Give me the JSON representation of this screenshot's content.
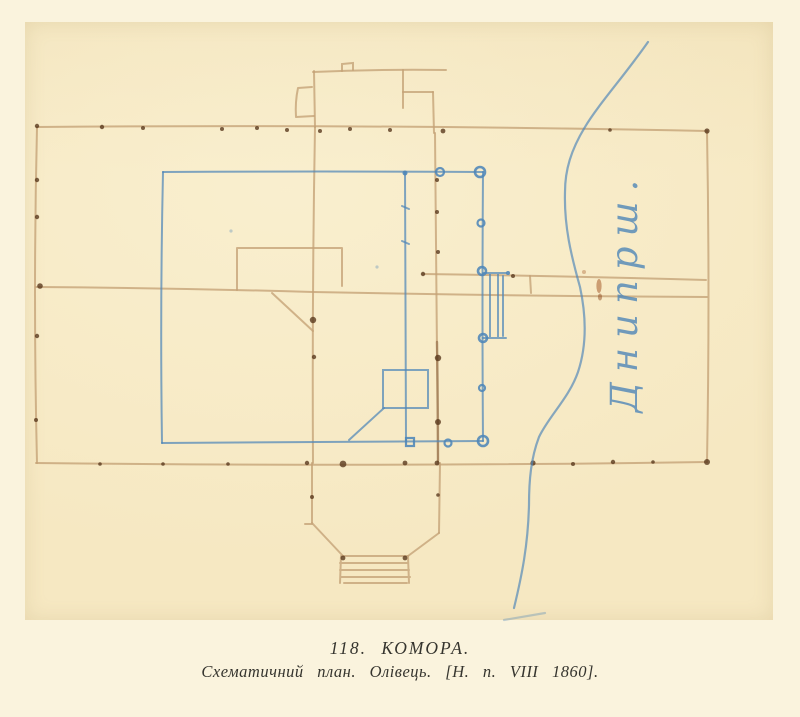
{
  "scan": {
    "page_color": "#faf3dd",
    "paper_color": "#f6e8c2",
    "pencil_color": "#c4a176",
    "pencil_dark_color": "#5a3a1e",
    "blue_color": "#4f86b8",
    "caption_color": "#35342e"
  },
  "drawing": {
    "river_label": "Днипрш."
  },
  "caption": {
    "line1": "118. КОМОРА.",
    "line2": "Схематичний план. Олівець. [Н. п. VIII 1860]."
  }
}
